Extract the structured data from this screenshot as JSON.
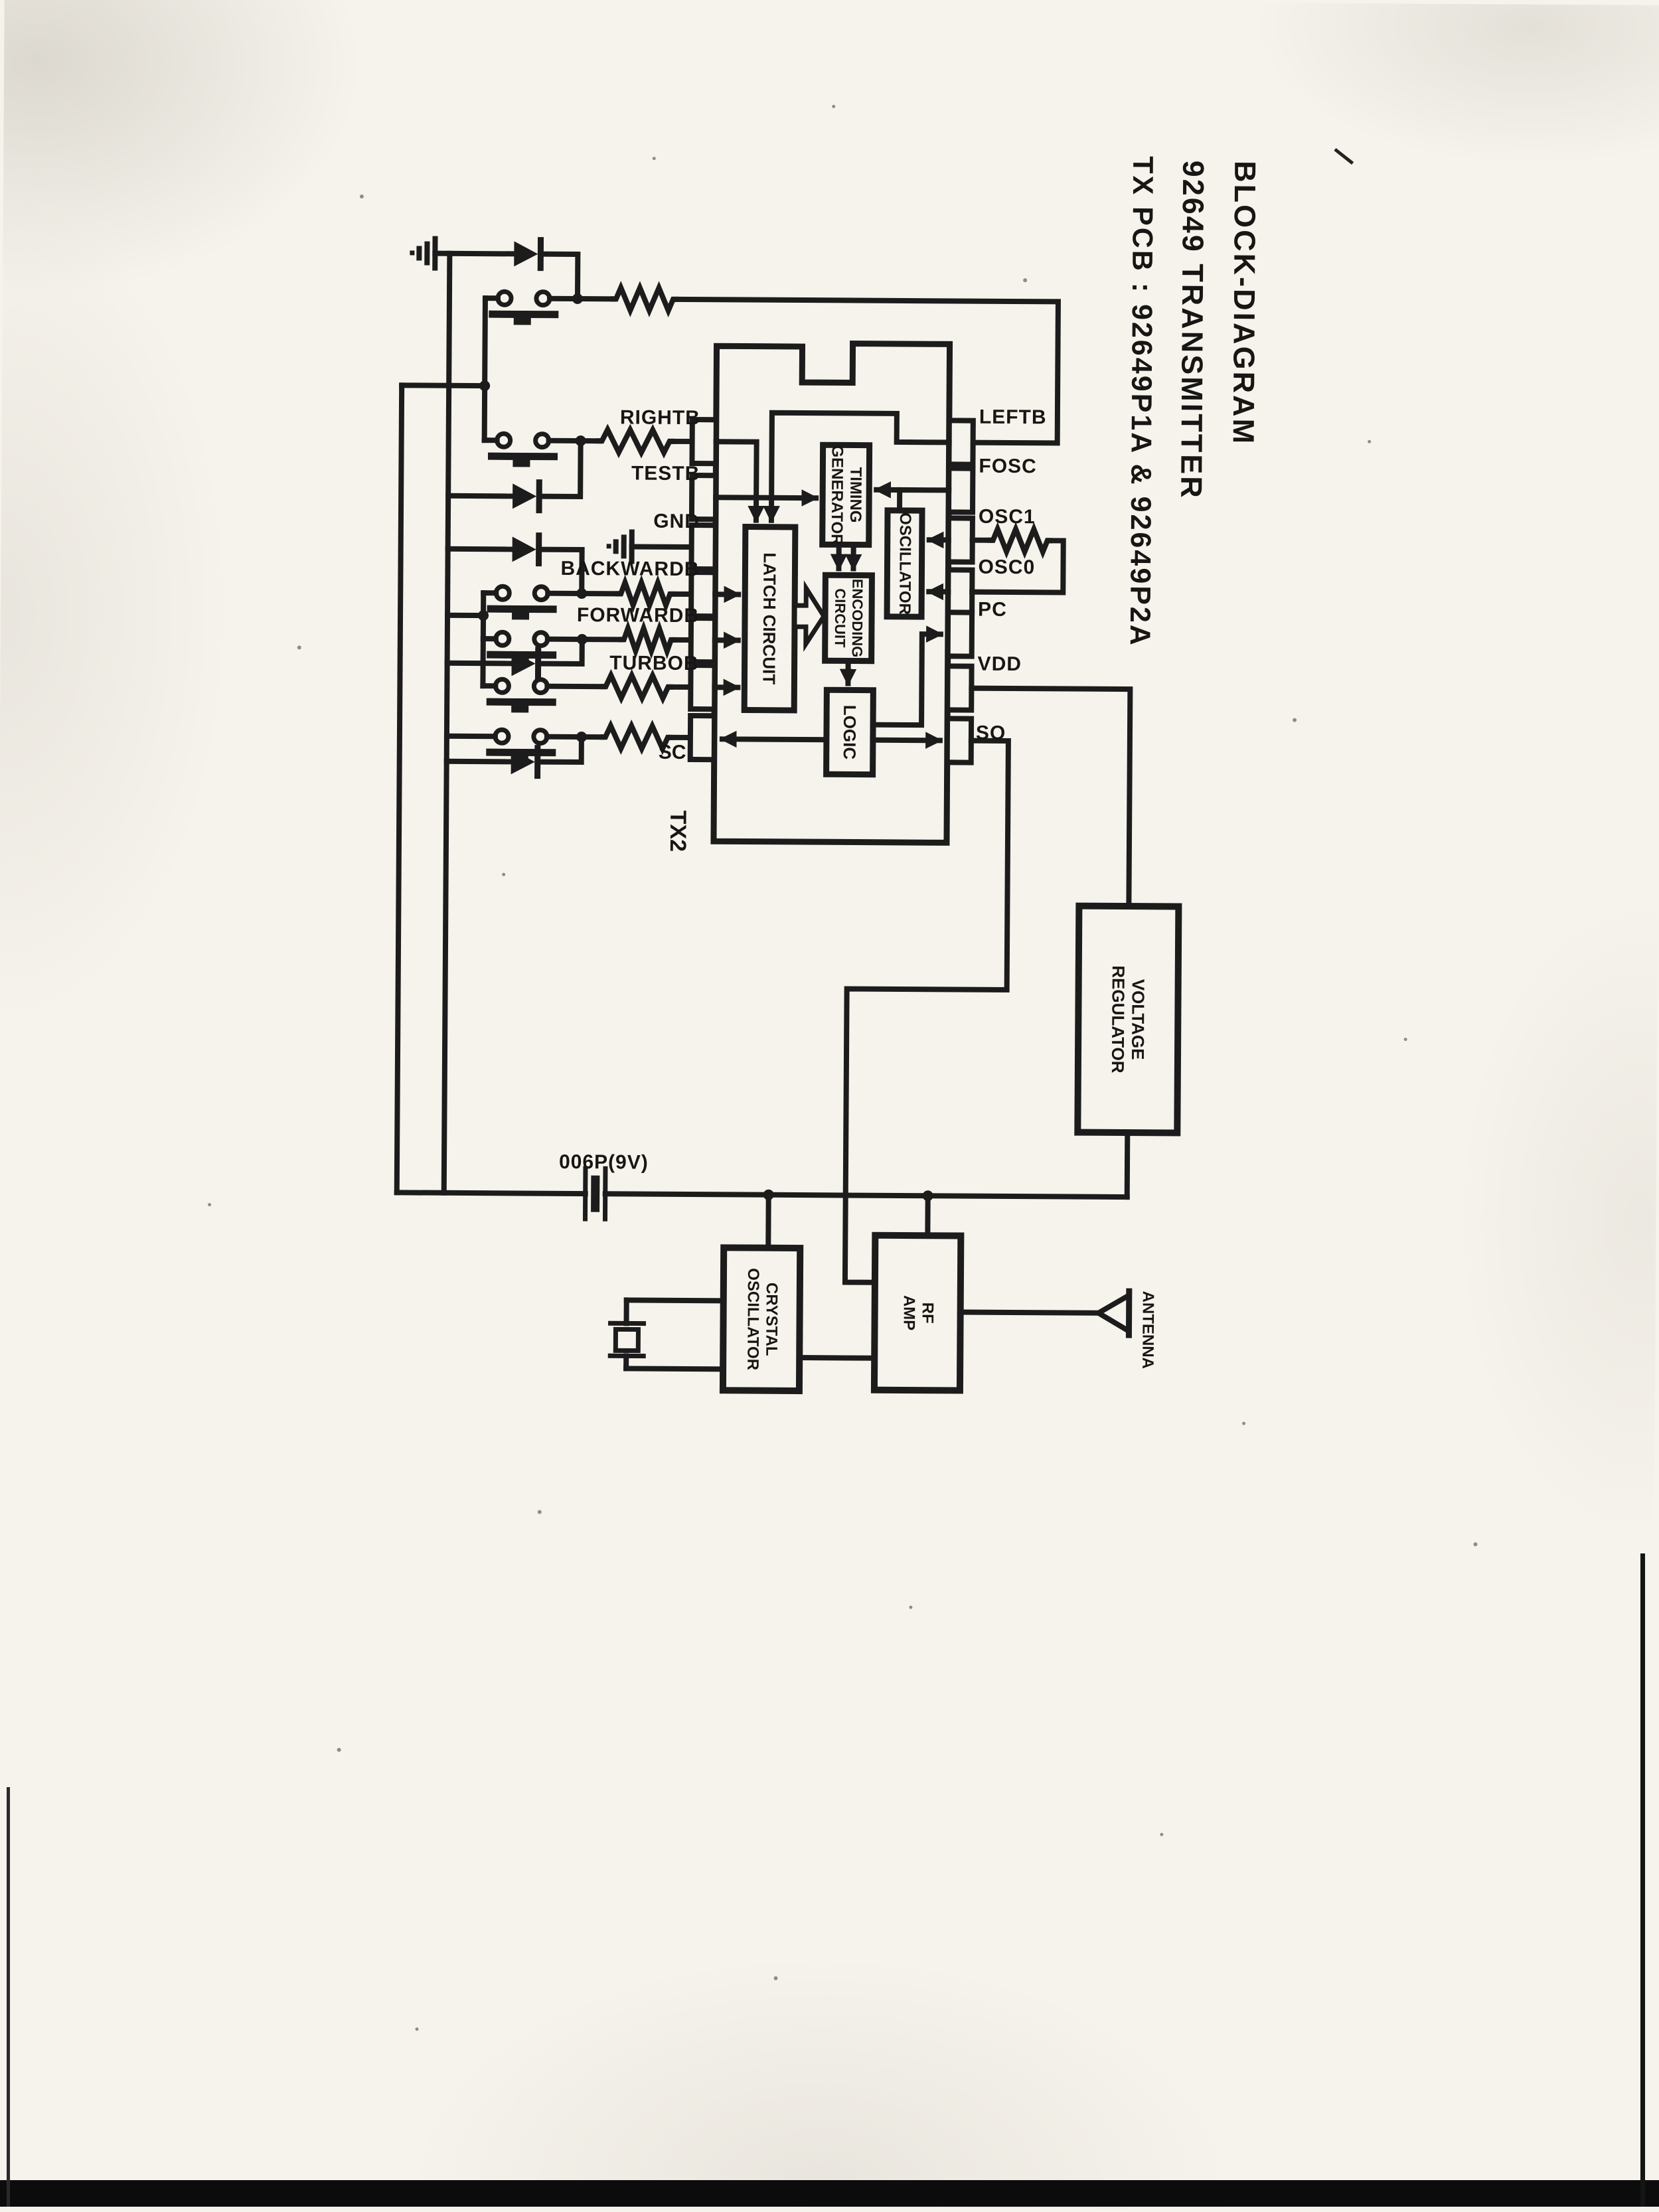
{
  "title": {
    "line1": "BLOCK-DIAGRAM",
    "line2": "92649 TRANSMITTER",
    "line3": "TX PCB : 92649P1A & 92649P2A"
  },
  "chip": {
    "designator": "TX2",
    "left_pins": [
      "RIGHTB",
      "TESTB",
      "GND",
      "BACKWARDB",
      "FORWARDB",
      "TURBOB",
      "SC"
    ],
    "right_pins": [
      "LEFTB",
      "FOSC",
      "OSC1",
      "OSC0",
      "PC",
      "VDD",
      "SO"
    ],
    "blocks": {
      "latch": "LATCH CIRCUIT",
      "timing": [
        "TIMING",
        "GENERATOR"
      ],
      "oscillator": "OSCILLATOR",
      "encoding": [
        "ENCODING",
        "CIRCUIT"
      ],
      "logic": "LOGIC"
    }
  },
  "power": {
    "battery_label": "006P(9V)",
    "regulator": [
      "VOLTAGE",
      "REGULATOR"
    ]
  },
  "rf": {
    "crystal_oscillator": [
      "CRYSTAL",
      "OSCILLATOR"
    ],
    "amplifier": [
      "RF",
      "AMP"
    ],
    "antenna_label": "ANTENNA"
  }
}
